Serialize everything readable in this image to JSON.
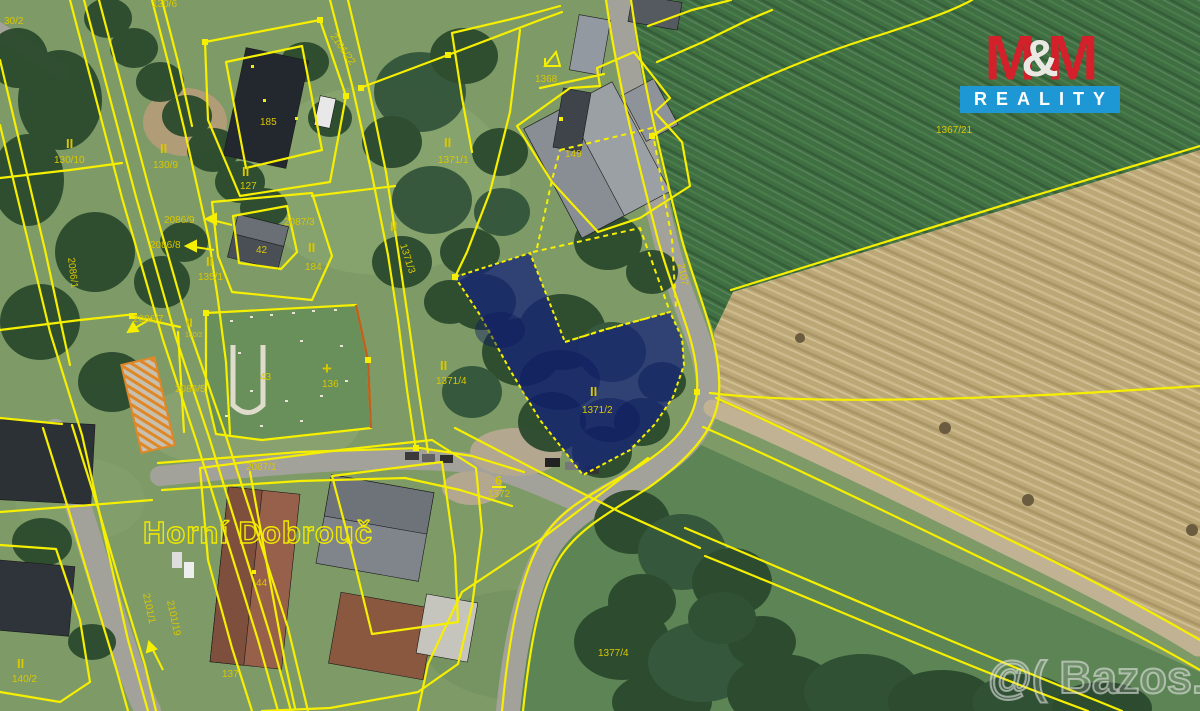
{
  "branding": {
    "m1": "M",
    "amp": "&",
    "m2": "M",
    "reality": "REALITY",
    "red": "#d3202a",
    "blue": "#1e98d5",
    "amp_color": "#eae8e2"
  },
  "watermark": {
    "text": "@( Bazos.cz"
  },
  "map": {
    "place_label": "Horní Dobrouč",
    "highlight_parcel": "1371/2",
    "colors": {
      "cadastral_line": "#f6ef00",
      "parcel_label": "#d9c700",
      "highlight_fill": "#142378"
    },
    "labels": [
      {
        "t": "30/2",
        "x": 4,
        "y": 24
      },
      {
        "t": "130/6",
        "x": 152,
        "y": 7
      },
      {
        "t": "2101/22",
        "x": 330,
        "y": 36,
        "r": 55
      },
      {
        "t": "II",
        "x": 66,
        "y": 148,
        "s": 13,
        "b": 1
      },
      {
        "t": "130/10",
        "x": 54,
        "y": 163
      },
      {
        "t": "II",
        "x": 160,
        "y": 153,
        "s": 13,
        "b": 1
      },
      {
        "t": "130/9",
        "x": 153,
        "y": 168
      },
      {
        "t": "185",
        "x": 260,
        "y": 125
      },
      {
        "t": "II",
        "x": 242,
        "y": 176,
        "s": 13,
        "b": 1
      },
      {
        "t": "127",
        "x": 240,
        "y": 189
      },
      {
        "t": "2086/9",
        "x": 164,
        "y": 223
      },
      {
        "t": "2087/3",
        "x": 284,
        "y": 225
      },
      {
        "t": "2086/8",
        "x": 150,
        "y": 248
      },
      {
        "t": "42",
        "x": 256,
        "y": 253
      },
      {
        "t": "II",
        "x": 308,
        "y": 252,
        "s": 13,
        "b": 1
      },
      {
        "t": "184",
        "x": 305,
        "y": 270
      },
      {
        "t": "II",
        "x": 206,
        "y": 266,
        "s": 13,
        "b": 1
      },
      {
        "t": "135/1",
        "x": 198,
        "y": 280
      },
      {
        "t": "1371/3",
        "x": 400,
        "y": 245,
        "r": 72
      },
      {
        "t": "2086/1",
        "x": 68,
        "y": 258,
        "r": 83
      },
      {
        "t": "2086/7",
        "x": 133,
        "y": 322
      },
      {
        "t": "II",
        "x": 186,
        "y": 327,
        "s": 12,
        "b": 1
      },
      {
        "t": "180/2",
        "x": 185,
        "y": 337,
        "s": 7
      },
      {
        "t": "2086/5",
        "x": 175,
        "y": 392
      },
      {
        "t": "43",
        "x": 260,
        "y": 380
      },
      {
        "t": "136",
        "x": 322,
        "y": 387
      },
      {
        "t": "+",
        "x": 322,
        "y": 374,
        "s": 17,
        "b": 1
      },
      {
        "t": "II",
        "x": 444,
        "y": 147,
        "s": 13,
        "b": 1
      },
      {
        "t": "1371/1",
        "x": 438,
        "y": 163
      },
      {
        "t": "149",
        "x": 565,
        "y": 157
      },
      {
        "t": "1368",
        "x": 535,
        "y": 82
      },
      {
        "t": "1367/21",
        "x": 936,
        "y": 133
      },
      {
        "t": "II",
        "x": 390,
        "y": 231,
        "s": 13,
        "b": 1
      },
      {
        "t": "II",
        "x": 440,
        "y": 370,
        "s": 13,
        "b": 1
      },
      {
        "t": "1371/4",
        "x": 436,
        "y": 384
      },
      {
        "t": "II",
        "x": 590,
        "y": 396,
        "s": 13,
        "b": 1
      },
      {
        "t": "1371/2",
        "x": 582,
        "y": 413
      },
      {
        "t": "2107",
        "x": 678,
        "y": 264,
        "r": 80
      },
      {
        "t": "6",
        "x": 495,
        "y": 485,
        "s": 13,
        "b": 1
      },
      {
        "t": "1372",
        "x": 488,
        "y": 497
      },
      {
        "t": "2087/1",
        "x": 246,
        "y": 470
      },
      {
        "t": "44",
        "x": 256,
        "y": 586
      },
      {
        "t": "137",
        "x": 222,
        "y": 677
      },
      {
        "t": "II",
        "x": 17,
        "y": 668,
        "s": 13,
        "b": 1
      },
      {
        "t": "140/2",
        "x": 12,
        "y": 682
      },
      {
        "t": "2101/1",
        "x": 143,
        "y": 594,
        "r": 78
      },
      {
        "t": "2101/19",
        "x": 167,
        "y": 601,
        "r": 78
      },
      {
        "t": "1377/4",
        "x": 598,
        "y": 656
      }
    ]
  }
}
